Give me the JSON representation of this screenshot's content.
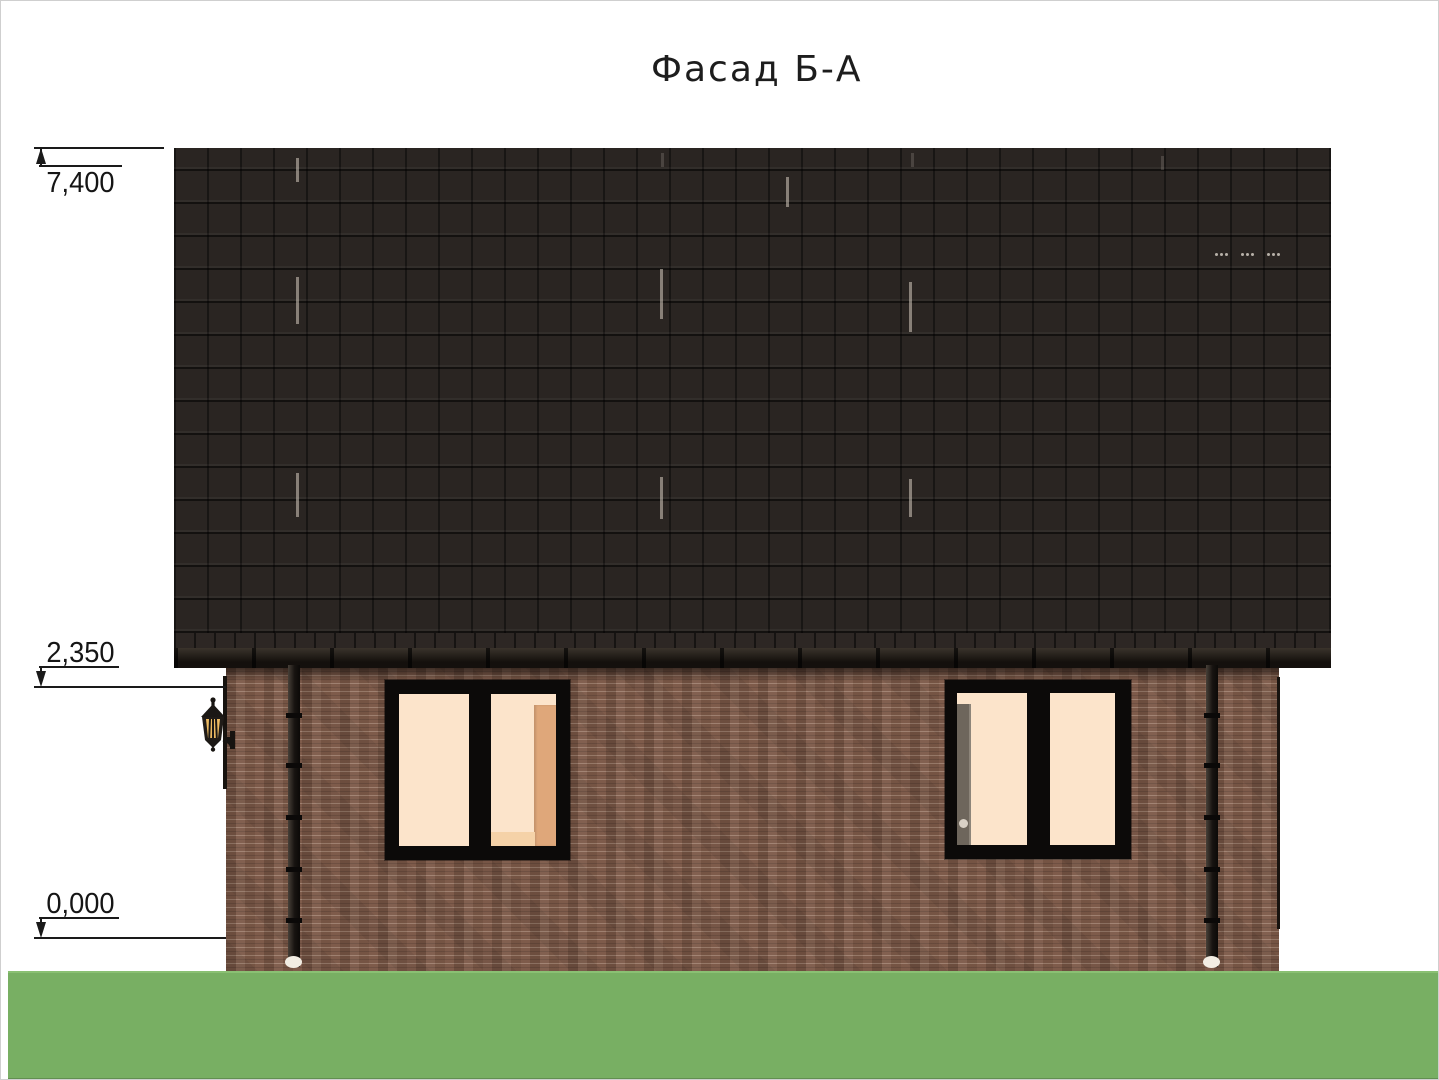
{
  "drawing": {
    "title": "Фасад Б-А"
  },
  "elevation_markers": [
    {
      "id": "roof_ridge",
      "label": "7,400",
      "direction": "up"
    },
    {
      "id": "eaves_level",
      "label": "2,350",
      "direction": "down"
    },
    {
      "id": "ground_level",
      "label": "0,000",
      "direction": "down"
    }
  ],
  "colors": {
    "paper": "#ffffff",
    "line": "#1a1a1a",
    "roof": "#2a2522",
    "fascia": "#14100d",
    "brick": "#7b5847",
    "frame": "#0c0a09",
    "glow": "#fce4cb",
    "warm": "#dfa77a",
    "grass": "#78af63",
    "grass_edge": "#8ac073"
  },
  "icons": {
    "lantern": "wall-lantern-icon",
    "arrow": "elevation-arrow-icon"
  }
}
